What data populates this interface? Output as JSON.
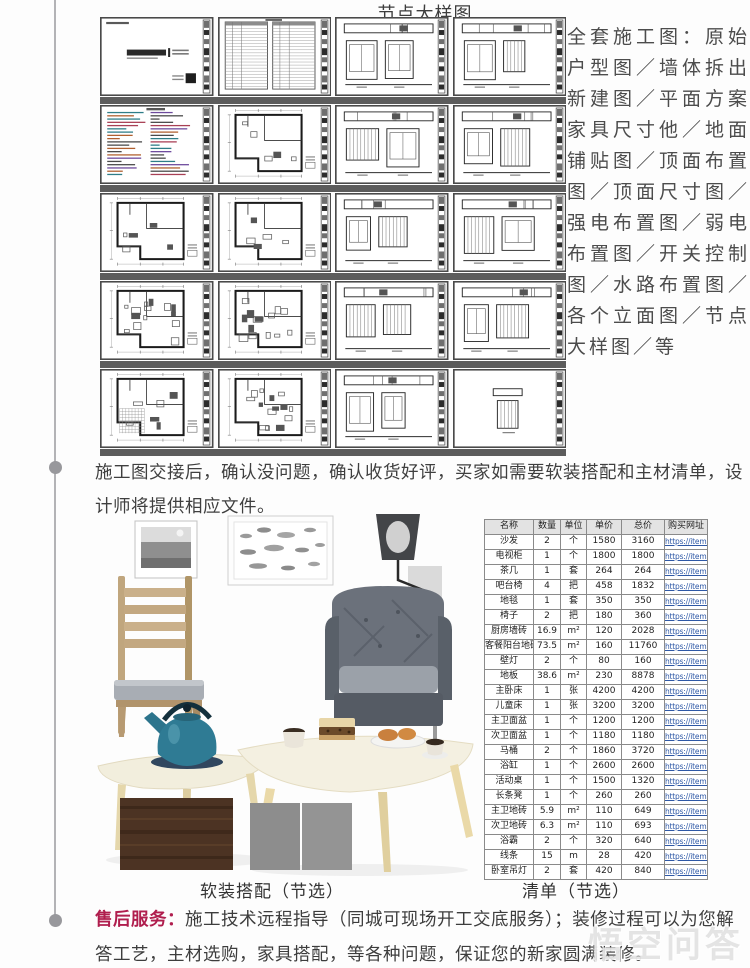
{
  "page": {
    "title": "节点大样图",
    "right_text": "全套施工图：原始户型图／墙体拆出新建图／平面方案家具尺寸他／地面铺贴图／顶面布置图／顶面尺寸图／强电布置图／弱电布置图／开关控制图／水路布置图／各个立面图／节点大样图／等",
    "para_handover": "施工图交接后，确认没问题，确认收货好评，买家如需要软装搭配和主材清单，设计师将提供相应文件。",
    "caption_soft": "软装搭配（节选）",
    "caption_list": "清单（节选）",
    "after_sale_label": "售后服务：",
    "after_sale_text": "施工技术远程指导（同城可现场开工交底服务）；装修过程可以为您解答工艺，主材选购，家具搭配，等各种问题，保证您的新家圆满装修。",
    "watermark": "悟空问答"
  },
  "drawings": {
    "thumbnails": [
      {
        "kind": "cover-sheet"
      },
      {
        "kind": "drawing-list"
      },
      {
        "kind": "elevation-sheet"
      },
      {
        "kind": "elevation-sheet"
      },
      {
        "kind": "design-notes"
      },
      {
        "kind": "floor-plan"
      },
      {
        "kind": "elevation-sheet"
      },
      {
        "kind": "elevation-sheet"
      },
      {
        "kind": "floor-plan"
      },
      {
        "kind": "floor-plan"
      },
      {
        "kind": "elevation-sheet"
      },
      {
        "kind": "elevation-sheet"
      },
      {
        "kind": "floor-plan-detailed"
      },
      {
        "kind": "floor-plan-detailed"
      },
      {
        "kind": "elevation-sheet"
      },
      {
        "kind": "elevation-sheet"
      },
      {
        "kind": "floor-plan-tiled"
      },
      {
        "kind": "floor-plan-detailed"
      },
      {
        "kind": "elevation-sheet"
      },
      {
        "kind": "elevation-single"
      }
    ]
  },
  "price_table": {
    "headers": [
      "名称",
      "数量",
      "单位",
      "单价",
      "总价",
      "购买网址"
    ],
    "link_text": "https://item.taob",
    "rows": [
      [
        "沙发",
        "2",
        "个",
        "1580",
        "3160"
      ],
      [
        "电视柜",
        "1",
        "个",
        "1800",
        "1800"
      ],
      [
        "茶几",
        "1",
        "套",
        "264",
        "264"
      ],
      [
        "吧台椅",
        "4",
        "把",
        "458",
        "1832"
      ],
      [
        "地毯",
        "1",
        "套",
        "350",
        "350"
      ],
      [
        "椅子",
        "2",
        "把",
        "180",
        "360"
      ],
      [
        "厨房墙砖",
        "16.9",
        "m²",
        "120",
        "2028"
      ],
      [
        "客餐阳台地砖",
        "73.5",
        "m²",
        "160",
        "11760"
      ],
      [
        "壁灯",
        "2",
        "个",
        "80",
        "160"
      ],
      [
        "地板",
        "38.6",
        "m²",
        "230",
        "8878"
      ],
      [
        "主卧床",
        "1",
        "张",
        "4200",
        "4200"
      ],
      [
        "儿童床",
        "1",
        "张",
        "3200",
        "3200"
      ],
      [
        "主卫面盆",
        "1",
        "个",
        "1200",
        "1200"
      ],
      [
        "次卫面盆",
        "1",
        "个",
        "1180",
        "1180"
      ],
      [
        "马桶",
        "2",
        "个",
        "1860",
        "3720"
      ],
      [
        "浴缸",
        "1",
        "个",
        "2600",
        "2600"
      ],
      [
        "活动桌",
        "1",
        "个",
        "1500",
        "1320"
      ],
      [
        "长条凳",
        "1",
        "个",
        "260",
        "260"
      ],
      [
        "主卫地砖",
        "5.9",
        "m²",
        "110",
        "649"
      ],
      [
        "次卫地砖",
        "6.3",
        "m²",
        "110",
        "693"
      ],
      [
        "浴霸",
        "2",
        "个",
        "320",
        "640"
      ],
      [
        "线条",
        "15",
        "m",
        "28",
        "420"
      ],
      [
        "卧室吊灯",
        "2",
        "套",
        "420",
        "840"
      ]
    ]
  },
  "colors": {
    "accent_red": "#b01e4e",
    "link_blue": "#2e58a6",
    "watermark_gray": "#cecece",
    "separator_gray": "#5c5c5c",
    "timeline_gray": "#b3b3b6"
  }
}
